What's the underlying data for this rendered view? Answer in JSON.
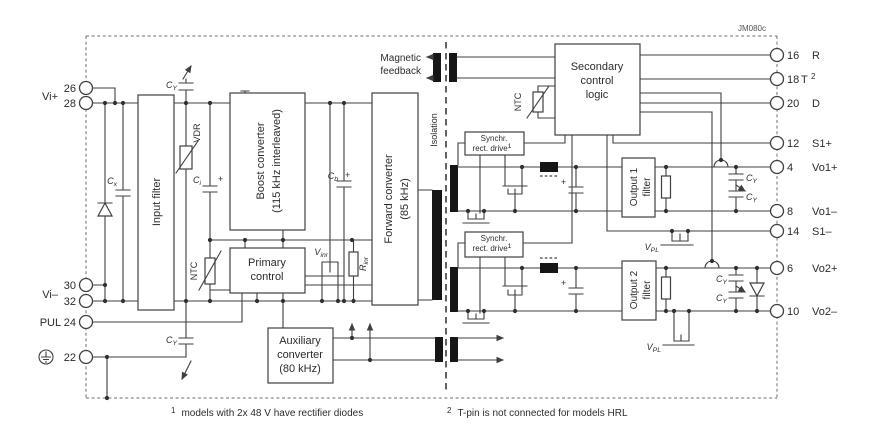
{
  "code": "JM080c",
  "colors": {
    "wire": "#3f3f3f",
    "text": "#2c2c2c",
    "bar": "#161616",
    "background": "#ffffff"
  },
  "left_pins": {
    "vi_plus": "Vi+",
    "p26": "26",
    "p28": "28",
    "vi_minus": "Vi–",
    "p30": "30",
    "p32": "32",
    "pul": "PUL 24",
    "p22": "22"
  },
  "right_pins": [
    {
      "number": "16",
      "name": "R",
      "sup": ""
    },
    {
      "number": "18",
      "name": "T",
      "sup": "2"
    },
    {
      "number": "20",
      "name": "D",
      "sup": ""
    },
    {
      "number": "12",
      "name": "S1+",
      "sup": ""
    },
    {
      "number": "4",
      "name": "Vo1+",
      "sup": ""
    },
    {
      "number": "8",
      "name": "Vo1–",
      "sup": ""
    },
    {
      "number": "14",
      "name": "S1–",
      "sup": ""
    },
    {
      "number": "6",
      "name": "Vo2+",
      "sup": ""
    },
    {
      "number": "10",
      "name": "Vo2–",
      "sup": ""
    }
  ],
  "blocks": {
    "input_filter": "Input filter",
    "boost_l1": "Boost converter",
    "boost_l2": "(115 kHz interleaved)",
    "forward_l1": "Forward converter",
    "forward_l2": "(85 kHz)",
    "primary_l1": "Primary",
    "primary_l2": "control",
    "secondary_l1": "Secondary",
    "secondary_l2": "control",
    "secondary_l3": "logic",
    "aux_l1": "Auxiliary",
    "aux_l2": "converter",
    "aux_l3": "(80 kHz)",
    "sync_l1": "Synchr.",
    "sync_l2": "rect. drive",
    "sync_sup": "1",
    "out1_l1": "Output 1",
    "out1_l2": "filter",
    "out2_l1": "Output 2",
    "out2_l2": "filter"
  },
  "labels": {
    "cap": "C",
    "sub_x": "x",
    "sub_y": "Y",
    "sub_i": "i",
    "sub_b": "b",
    "v": "V",
    "r": "R",
    "sub_inr": "inr",
    "sub_pl": "PL",
    "vdr": "VDR",
    "ntc": "NTC",
    "plus": "+",
    "mag1": "Magnetic",
    "mag2": "feedback",
    "isolation": "Isolation"
  },
  "footnotes": {
    "fn1_sup": "1",
    "fn1": "models with 2x 48 V have rectifier diodes",
    "fn2_sup": "2",
    "fn2": "T-pin is not connected for models HRL"
  }
}
